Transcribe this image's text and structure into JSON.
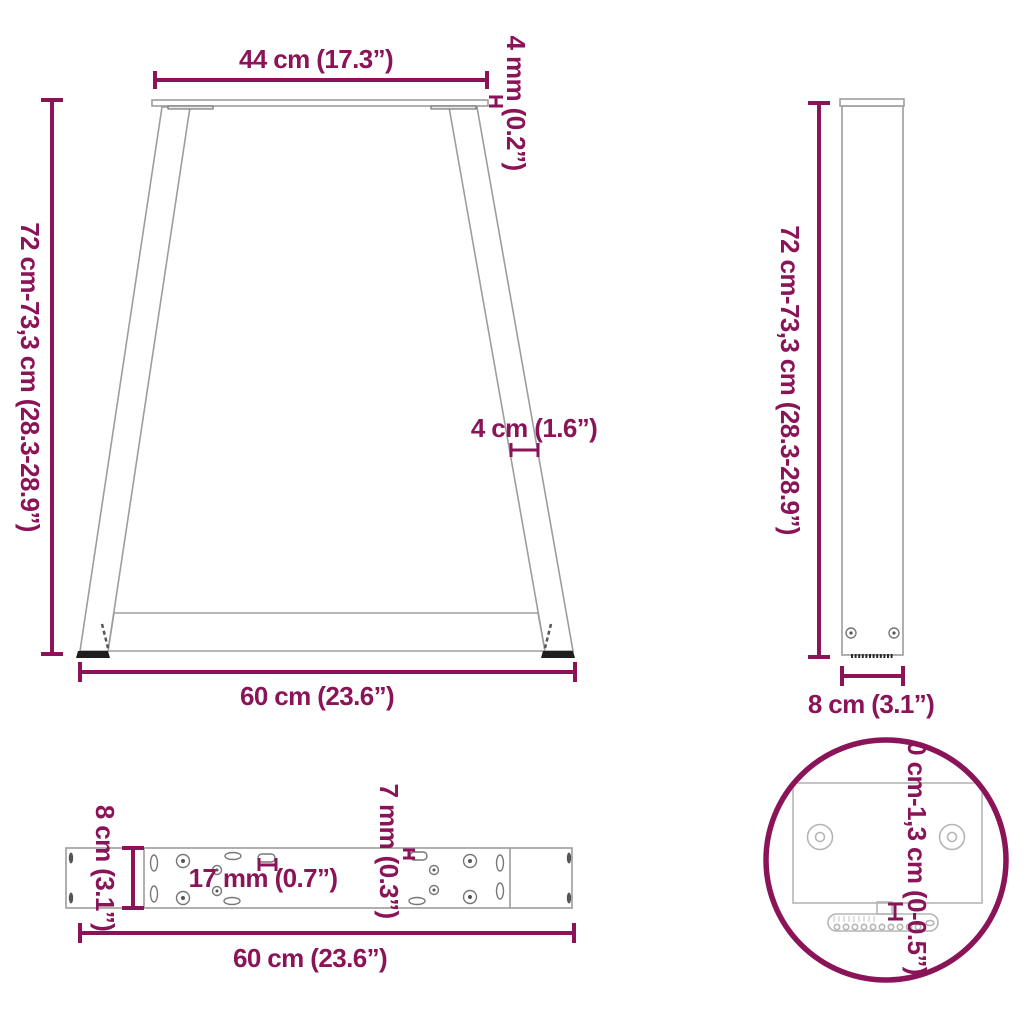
{
  "colors": {
    "accent": "#8A1457",
    "line": "#9d9d9d",
    "line_dark": "#777777",
    "line_light": "#b5b5b5",
    "foot": "#1e1e1e",
    "background": "#ffffff"
  },
  "diagram": {
    "description": "Table leg dimensions diagram, front view, side view, mounting plate top view and adjustable foot detail",
    "front_view": {
      "top_width": "44 cm (17.3”)",
      "top_plate_thickness": "4 mm (0.2”)",
      "height_range": "72 cm-73,3 cm (28.3-28.9”)",
      "leg_profile_width": "4 cm (1.6”)",
      "bottom_width": "60 cm (23.6”)"
    },
    "side_view": {
      "height_range": "72 cm-73,3 cm (28.3-28.9”)",
      "depth": "8 cm (3.1”)"
    },
    "plate_top_view": {
      "depth": "8 cm (3.1”)",
      "slot_length": "17 mm (0.7”)",
      "slot_width": "7 mm (0.3”)",
      "length": "60 cm (23.6”)"
    },
    "foot_detail_view": {
      "height_adjustment_range": "0 cm-1,3 cm (0-0.5”)"
    }
  }
}
